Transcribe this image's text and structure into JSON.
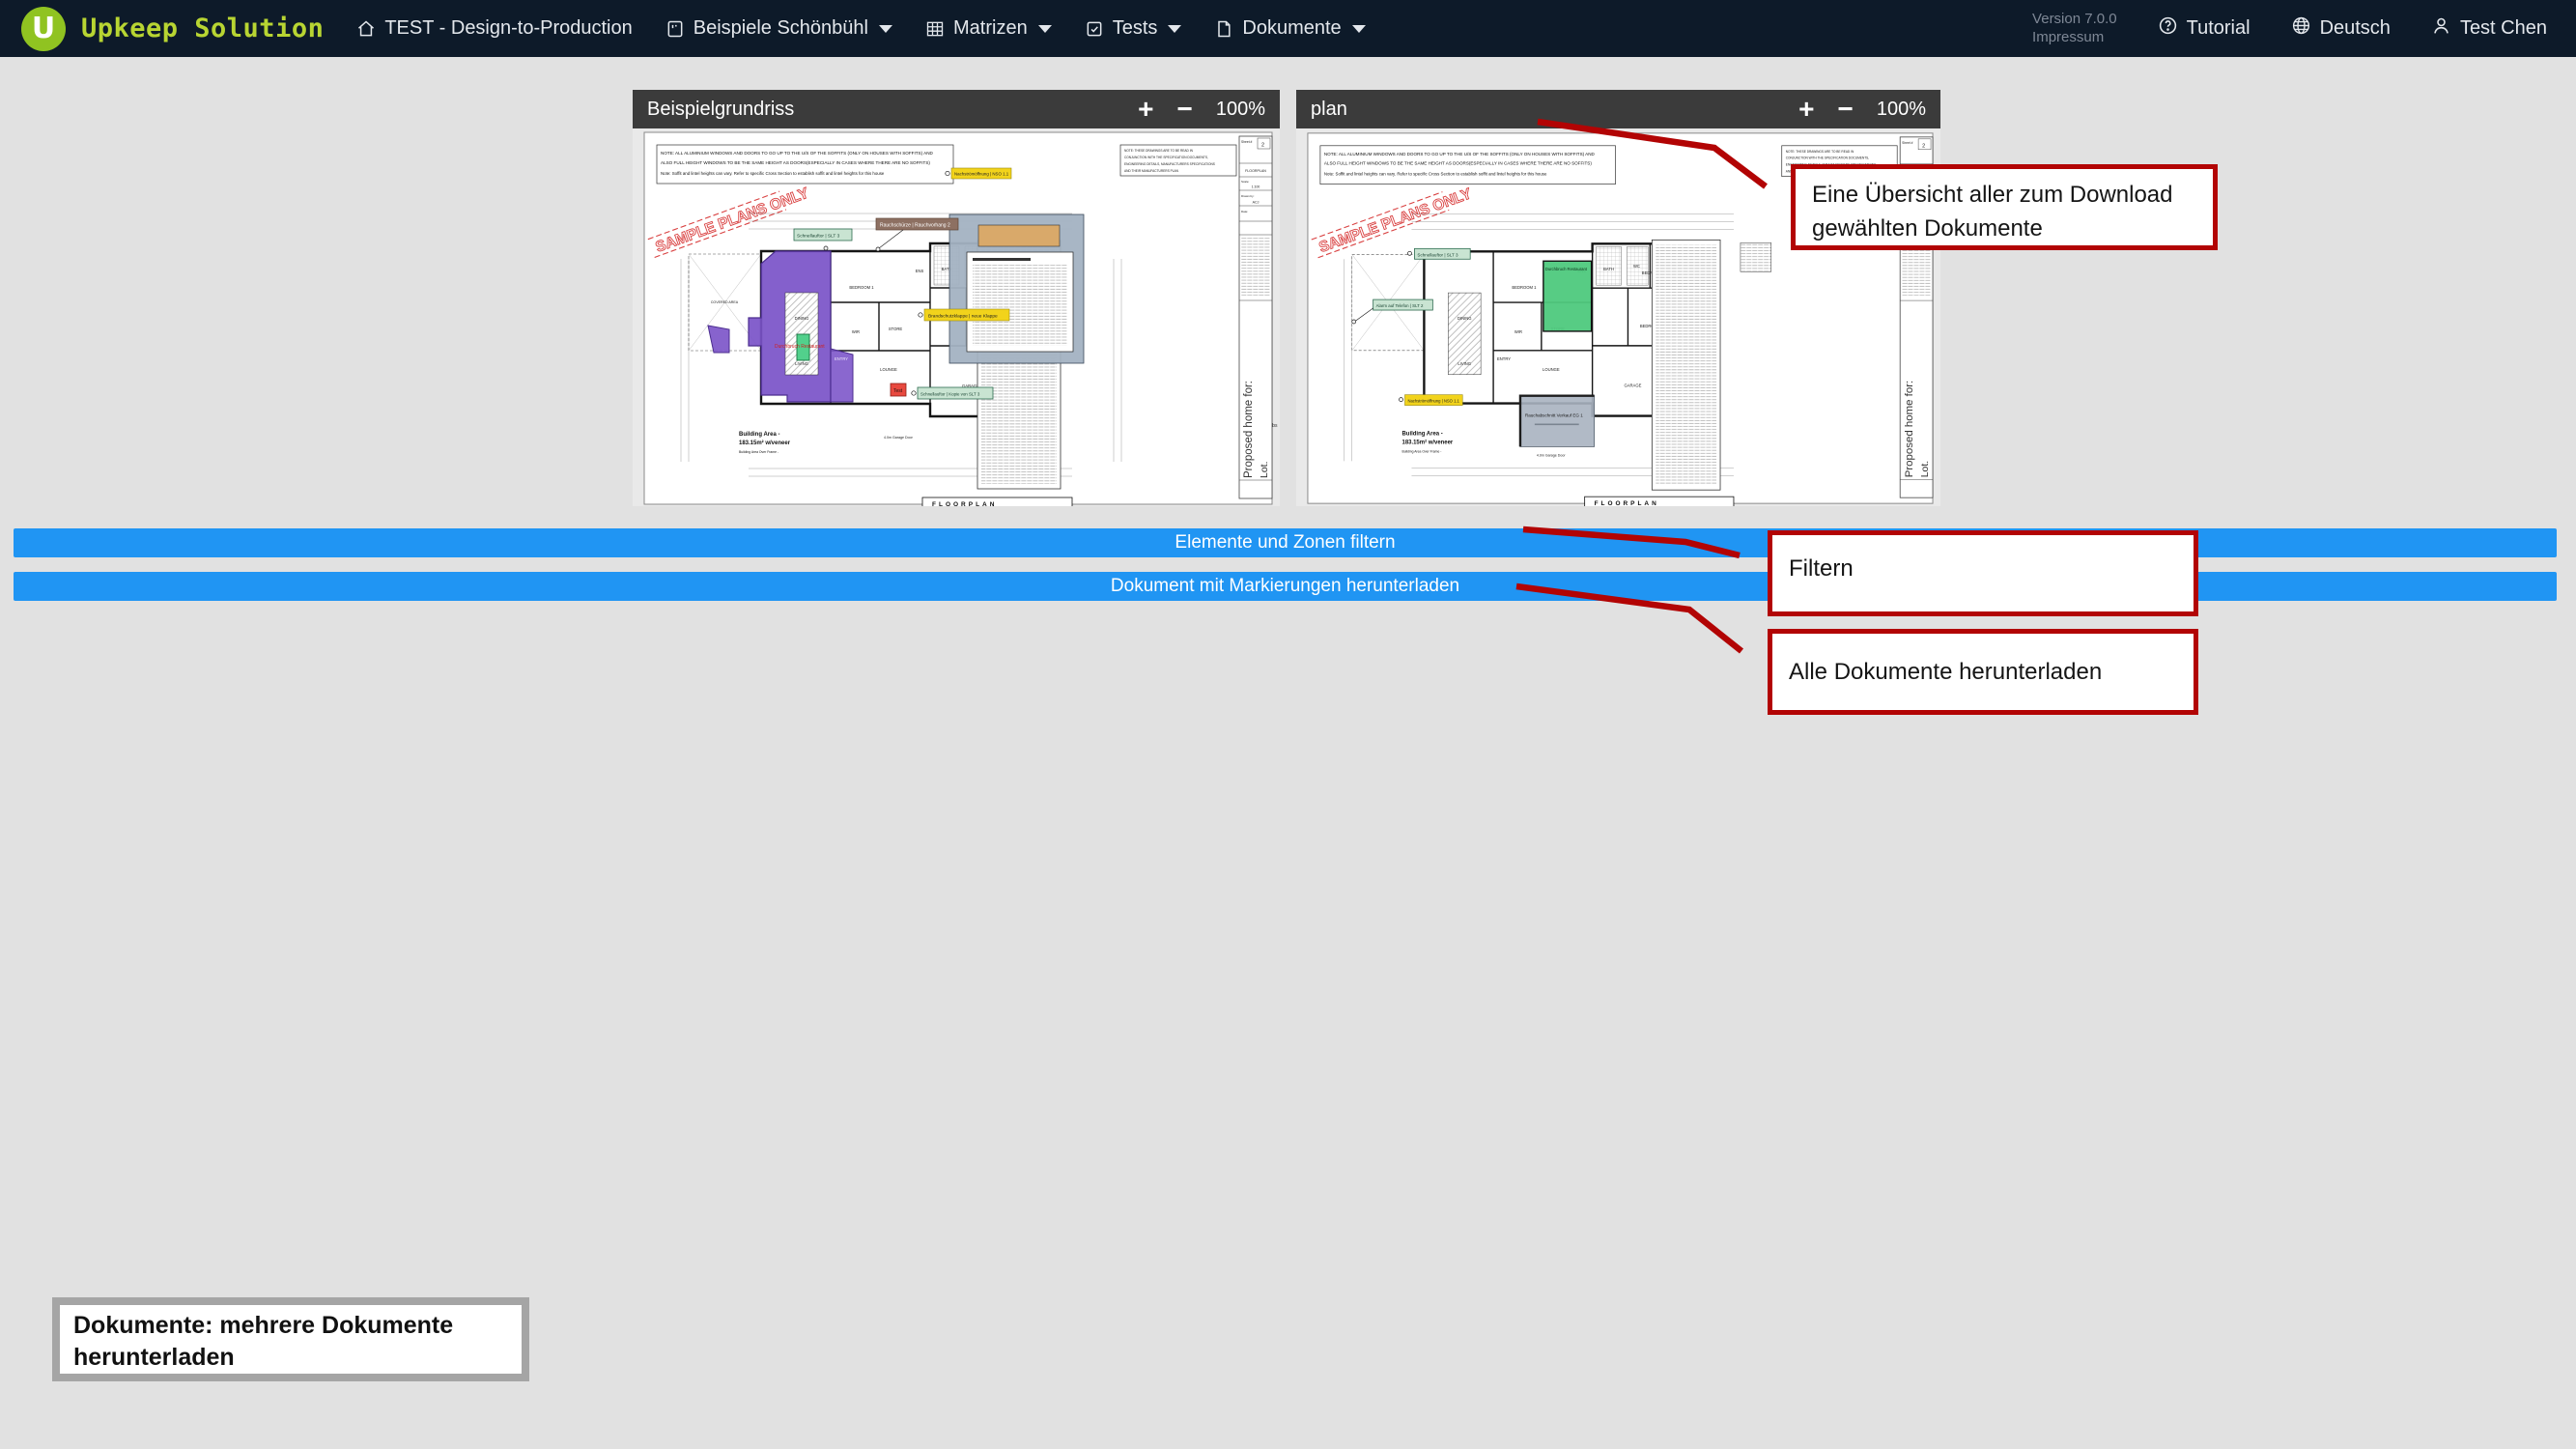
{
  "nav": {
    "logo_letter": "U",
    "brand": "Upkeep Solution",
    "items": [
      {
        "label": "TEST - Design-to-Production"
      },
      {
        "label": "Beispiele Schönbühl"
      },
      {
        "label": "Matrizen"
      },
      {
        "label": "Tests"
      },
      {
        "label": "Dokumente"
      }
    ],
    "version": "Version 7.0.0",
    "impressum": "Impressum",
    "tutorial": "Tutorial",
    "language": "Deutsch",
    "user": "Test Chen"
  },
  "viewers": {
    "left": {
      "title": "Beispielgrundriss",
      "zoom_in": "+",
      "zoom_out": "−",
      "zoom_level": "100%"
    },
    "right": {
      "title": "plan",
      "zoom_in": "+",
      "zoom_out": "−",
      "zoom_level": "100%"
    }
  },
  "action_buttons": {
    "filter": "Elemente und Zonen filtern",
    "download": "Dokument mit Markierungen herunterladen"
  },
  "callouts": {
    "overview": "Eine Übersicht aller zum Download gewählten Dokumente",
    "filter": "Filtern",
    "download_all": "Alle Dokumente herunterladen",
    "caption": "Dokumente: mehrere Dokumente herunterladen"
  },
  "plan_common": {
    "watermark": "SAMPLE PLANS ONLY",
    "note_left_lines": [
      "NOTE: ALL ALUMINIUM WINDOWS AND DOORS TO GO UP TO THE U/S OF THE SOFFITS (ONLY ON HOUSES WITH SOFFITS) AND",
      "ALSO FULL HEIGHT WINDOWS TO BE THE SAME HEIGHT AS DOORS(ESPECIALLY IN CASES WHERE THERE ARE NO SOFFITS)",
      "Note: Soffit and lintel heights can vary. Refer to specific Cross Section to establish soffit and lintel heights for this house"
    ],
    "note_right_lines": [
      "NOTE: THESE DRAWINGS ARE TO BE READ IN",
      "CONJUNCTION WITH THE SPECIFICATION DOCUMENTS,",
      "ENGINEERING DETAILS, MANUFACTURERS SPECIFICATIONS",
      "AND THEIR MANUFACTURERS PLAN"
    ],
    "titleblock": {
      "sheet_label": "Sheet #",
      "sheet_number": "2",
      "doc_name": "FLOORPLAN",
      "scale_label": "Scale:",
      "scale": "1:100",
      "drawn_label": "Drawn by:",
      "drawn_by": "ACJ",
      "date_label": "Date:"
    },
    "proposed": "Proposed home for:",
    "lot": "Lot.",
    "building_area_1": "Building Area -",
    "building_area_2": "183.15m² w/veneer",
    "building_area_3": "Building Area Over Frame -",
    "floorplan_label": "FLOORPLAN",
    "garage_door": "4.0m Garage Door",
    "rooms": {
      "covered": "COVERED AREA",
      "bed1": "BEDROOM 1",
      "bed2": "BEDROOM 2",
      "bed3": "BEDROOM 3",
      "dining": "DINING",
      "living": "LIVING",
      "lounge": "LOUNGE",
      "garage": "GARAGE",
      "entry": "ENTRY",
      "wir": "WIR",
      "store": "STORE",
      "bath": "BATH",
      "ens": "ENS",
      "wc": "WC"
    }
  },
  "plan_left_markers": {
    "nso": "Nachströmöffnung | NSO 1.1",
    "rauchschuerze": "Rauchschürze | Rauchvorhang 2",
    "slt3": "Schnellauftor | SLT 3",
    "brandschutzklappe": "Brandschutzklappe | neue Klappe",
    "slt3_copy": "Schnellauftor | Kopie von SLT 3",
    "test": "Test",
    "durchbruch": "Durchbruch Restaurant",
    "rauchabs_clip": "Rauchabs"
  },
  "plan_right_markers": {
    "slt3": "Schnellauftor | SLT 3",
    "alarm": "Alarm auf Telefon | SLT 2",
    "nso": "Nachströmöffnung | NSO 1.1",
    "durchbruch_zone": "Durchbruch Restaurant",
    "rauch_zone": "Rauchabschnitt Verkauf EG 1"
  },
  "colors": {
    "nav_bg": "#0d1a29",
    "brand_green": "#b8d532",
    "logo_green": "#90c321",
    "accent_blue": "#2095f3",
    "annotation_red": "#b20404",
    "viewer_header_gray": "#3b3b3b",
    "zone_purple": "#7a52c8",
    "zone_green": "#4ec97d",
    "zone_gray": "#a8b3c0",
    "label_yellow": "#f2d31b",
    "label_green": "#c9e4d2",
    "label_brown": "#8d7062",
    "watermark_red": "#d94040"
  }
}
